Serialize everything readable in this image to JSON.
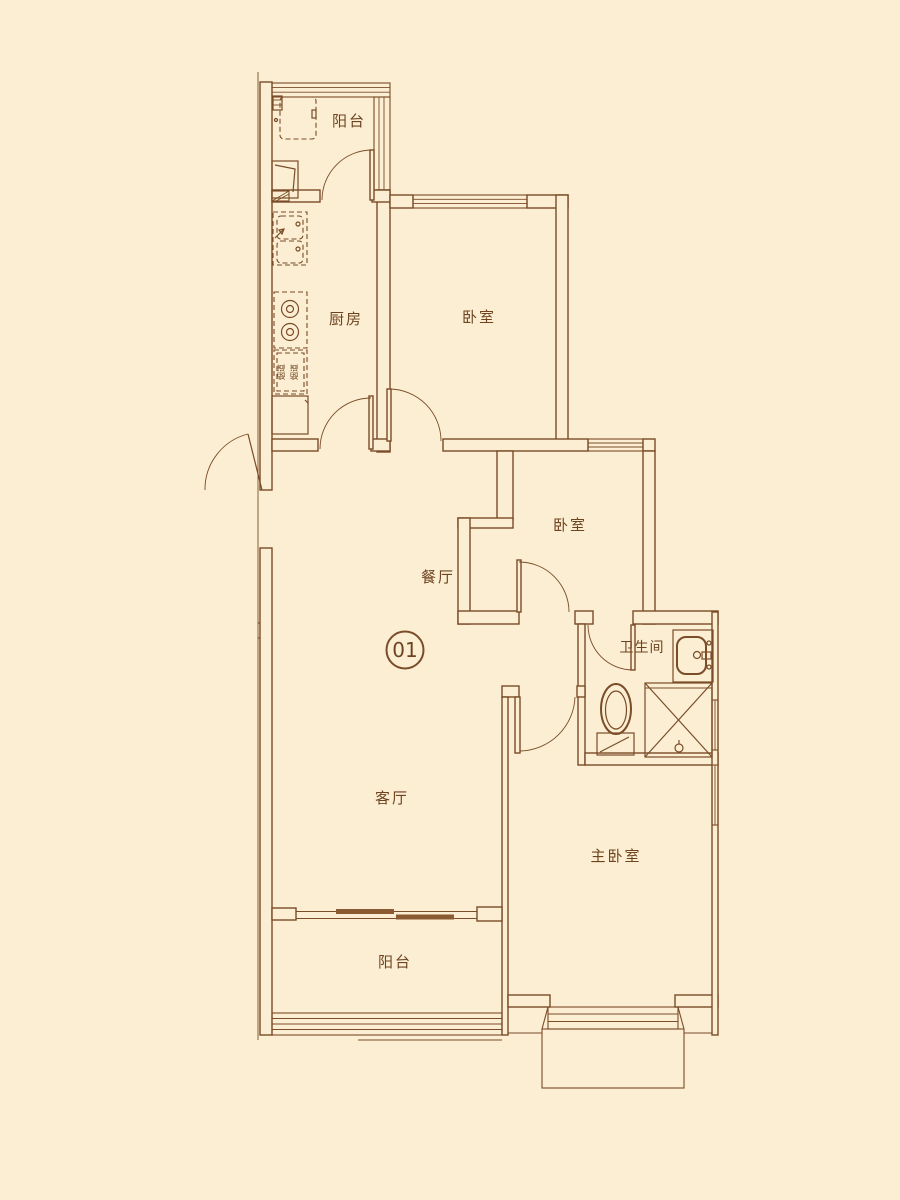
{
  "unit_badge": {
    "number": "01"
  },
  "rooms": {
    "balcony_top": {
      "label": "阳台"
    },
    "kitchen": {
      "label": "厨房"
    },
    "bedroom_top": {
      "label": "卧室"
    },
    "bedroom_middle": {
      "label": "卧室"
    },
    "dining": {
      "label": "餐厅"
    },
    "living": {
      "label": "客厅"
    },
    "bathroom": {
      "label": "卫生间"
    },
    "master_bedroom": {
      "label": "主卧室"
    },
    "balcony_bottom": {
      "label": "阳台"
    }
  },
  "annotations": {
    "kitchen_flue": "烟道"
  },
  "colors": {
    "background": "#FBEED3",
    "line": "#7A4C28",
    "leaf_fill": "#8A5B33",
    "text": "#6E4320"
  }
}
